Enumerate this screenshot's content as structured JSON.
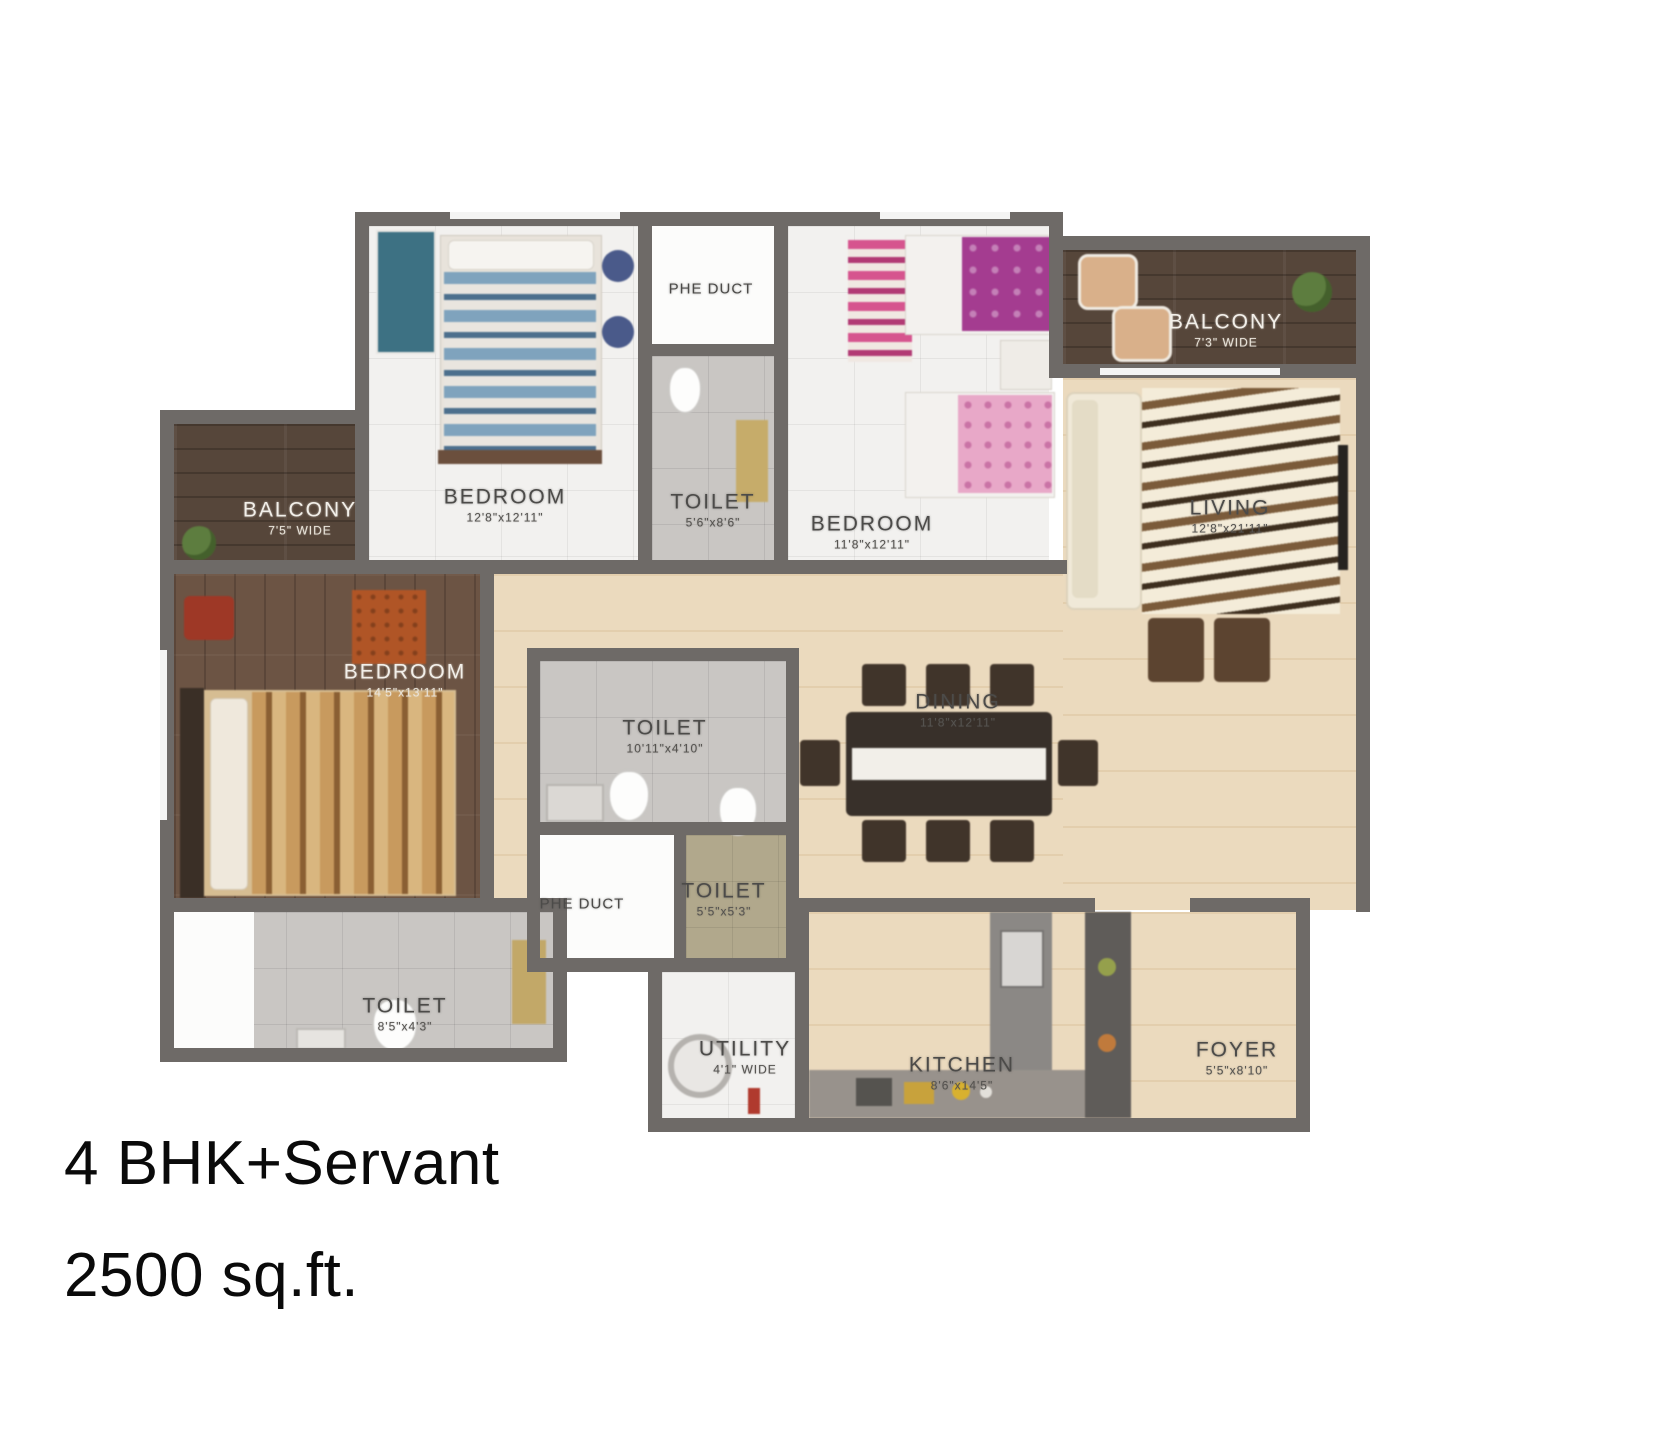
{
  "plan": {
    "type": "apartment-floor-plan",
    "caption": {
      "line1": "4 BHK+Servant",
      "line2": "2500 sq.ft."
    }
  },
  "rooms": [
    {
      "id": "bedroom-1",
      "name": "BEDROOM",
      "dim": "12'8\"x12'11\""
    },
    {
      "id": "phe-duct-1",
      "name": "PHE DUCT",
      "dim": ""
    },
    {
      "id": "toilet-1",
      "name": "TOILET",
      "dim": "5'6\"x8'6\""
    },
    {
      "id": "bedroom-2",
      "name": "BEDROOM",
      "dim": "11'8\"x12'11\""
    },
    {
      "id": "balcony-1",
      "name": "BALCONY",
      "dim": "7'3\" WIDE"
    },
    {
      "id": "living",
      "name": "LIVING",
      "dim": "12'8\"x21'11\""
    },
    {
      "id": "balcony-2",
      "name": "BALCONY",
      "dim": "7'5\" WIDE"
    },
    {
      "id": "bedroom-3",
      "name": "BEDROOM",
      "dim": "14'5\"x13'11\""
    },
    {
      "id": "toilet-2",
      "name": "TOILET",
      "dim": "10'11\"x4'10\""
    },
    {
      "id": "phe-duct-2",
      "name": "PHE DUCT",
      "dim": ""
    },
    {
      "id": "toilet-3",
      "name": "TOILET",
      "dim": "5'5\"x5'3\""
    },
    {
      "id": "dining",
      "name": "DINING",
      "dim": "11'8\"x12'11\""
    },
    {
      "id": "toilet-4",
      "name": "TOILET",
      "dim": "8'5\"x4'3\""
    },
    {
      "id": "utility",
      "name": "UTILITY",
      "dim": "4'1\" WIDE"
    },
    {
      "id": "kitchen",
      "name": "KITCHEN",
      "dim": "8'6\"x14'5\""
    },
    {
      "id": "foyer",
      "name": "FOYER",
      "dim": "5'5\"x8'10\""
    }
  ],
  "colors": {
    "wall": "#6e6a67",
    "floor_beige": "#ebdabe",
    "floor_wood_dark": "#56463a",
    "floor_wood_brown": "#6c5444",
    "accent_blue_bed": "#7fa3bd",
    "accent_magenta_bed": "#a43c90",
    "accent_pink_bed": "#e8a8c8",
    "accent_rug_orange": "#b05526",
    "label_dark": "#4c4b49",
    "label_light": "#f2efe9"
  }
}
